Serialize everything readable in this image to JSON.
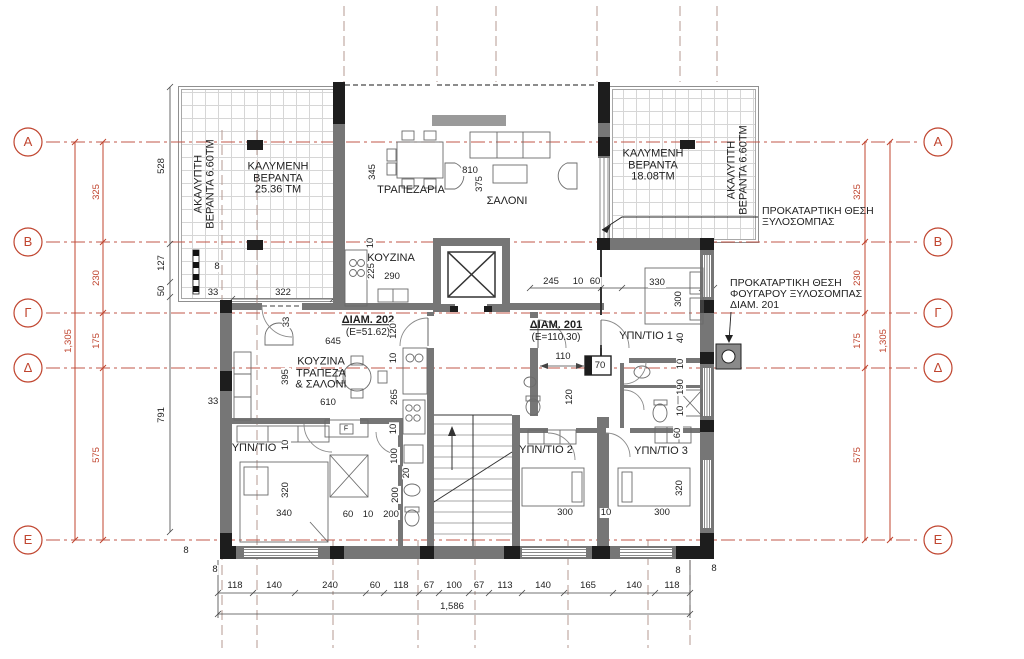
{
  "drawing": {
    "type": "architectural floor plan",
    "accent_red": "#c0452f",
    "wall_gray": "#767676",
    "wall_dark": "#1d1d1d"
  },
  "grid_rows_left": [
    "Α",
    "Β",
    "Γ",
    "Δ",
    "Ε"
  ],
  "grid_rows_right": [
    "Α",
    "Β",
    "Γ",
    "Δ",
    "Ε"
  ],
  "red_dims_left": {
    "segments": [
      "325",
      "230",
      "175",
      "575"
    ],
    "total": "1,305"
  },
  "red_dims_right": {
    "segments": [
      "325",
      "230",
      "175",
      "575"
    ],
    "total": "1,305"
  },
  "black_dims_left": [
    "528",
    "127",
    "50",
    "791"
  ],
  "bottom_chain": {
    "segments": [
      "118",
      "140",
      "240",
      "60",
      "118",
      "67",
      "100",
      "67",
      "113",
      "140",
      "165",
      "140",
      "118"
    ],
    "total": "1,586",
    "wall_ticks": [
      "8",
      "8",
      "8",
      "8"
    ]
  },
  "rooms": {
    "veranda_left_covered": [
      "ΚΑΛΥΜΕΝΗ",
      "ΒΕΡΑΝΤΑ",
      "25.36 ΤΜ"
    ],
    "veranda_left_open": [
      "ΑΚΑΛΥΠΤΗ",
      "ΒΕΡΑΝΤΑ  6.60ΤΜ"
    ],
    "veranda_right_covered": [
      "ΚΑΛΥΜΕΝΗ",
      "ΒΕΡΑΝΤΑ",
      "18.08ΤΜ"
    ],
    "veranda_right_open": [
      "ΑΚΑΛΥΠΤΗ",
      "ΒΕΡΑΝΤΑ  6.60ΤΜ"
    ],
    "dining": "ΤΡΑΠΕΖΑΡΙΑ",
    "living": "ΣΑΛΟΝΙ",
    "kitchen": "ΚΟΥΖΙΝΑ",
    "apt202_living": [
      "ΚΟΥΖΙΝΑ",
      "ΤΡΑΠΕΖΑ",
      "& ΣΑΛΟΝΙ"
    ],
    "bedroom_left": "ΥΠΝ/ΤΙΟ",
    "bedroom1": "ΥΠΝ/ΤΙΟ 1",
    "bedroom2": "ΥΠΝ/ΤΙΟ 2",
    "bedroom3": "ΥΠΝ/ΤΙΟ 3",
    "fixture_f": "F"
  },
  "apartments": {
    "apt202": {
      "name": "ΔΙΑΜ. 202",
      "area": "(E=51.62)"
    },
    "apt201": {
      "name": "ΔΙΑΜ. 201",
      "area": "(E=110.30)"
    }
  },
  "annotations": {
    "stove_note": [
      "ΠΡΟΚΑΤΑΡΤΙΚΗ ΘΕΣΗ",
      "ΞΥΛΟΣΟΜΠΑΣ"
    ],
    "chimney_note": [
      "ΠΡΟΚΑΤΑΡΤΙΚΗ ΘΕΣΗ",
      "ΦΟΥΓΑΡΟΥ ΞΥΛΟΣΟΜΠΑΣ",
      "ΔΙΑΜ. 201"
    ]
  },
  "plan_dims": [
    "345",
    "810",
    "375",
    "8",
    "33",
    "322",
    "33",
    "10",
    "225",
    "290",
    "245",
    "10",
    "60",
    "330",
    "300",
    "110",
    "120",
    "70",
    "40",
    "10",
    "190",
    "10",
    "60",
    "645",
    "120",
    "10",
    "265",
    "10",
    "100",
    "20",
    "200",
    "395",
    "610",
    "33",
    "10",
    "320",
    "340",
    "60",
    "10",
    "200",
    "300",
    "10",
    "300",
    "320"
  ]
}
